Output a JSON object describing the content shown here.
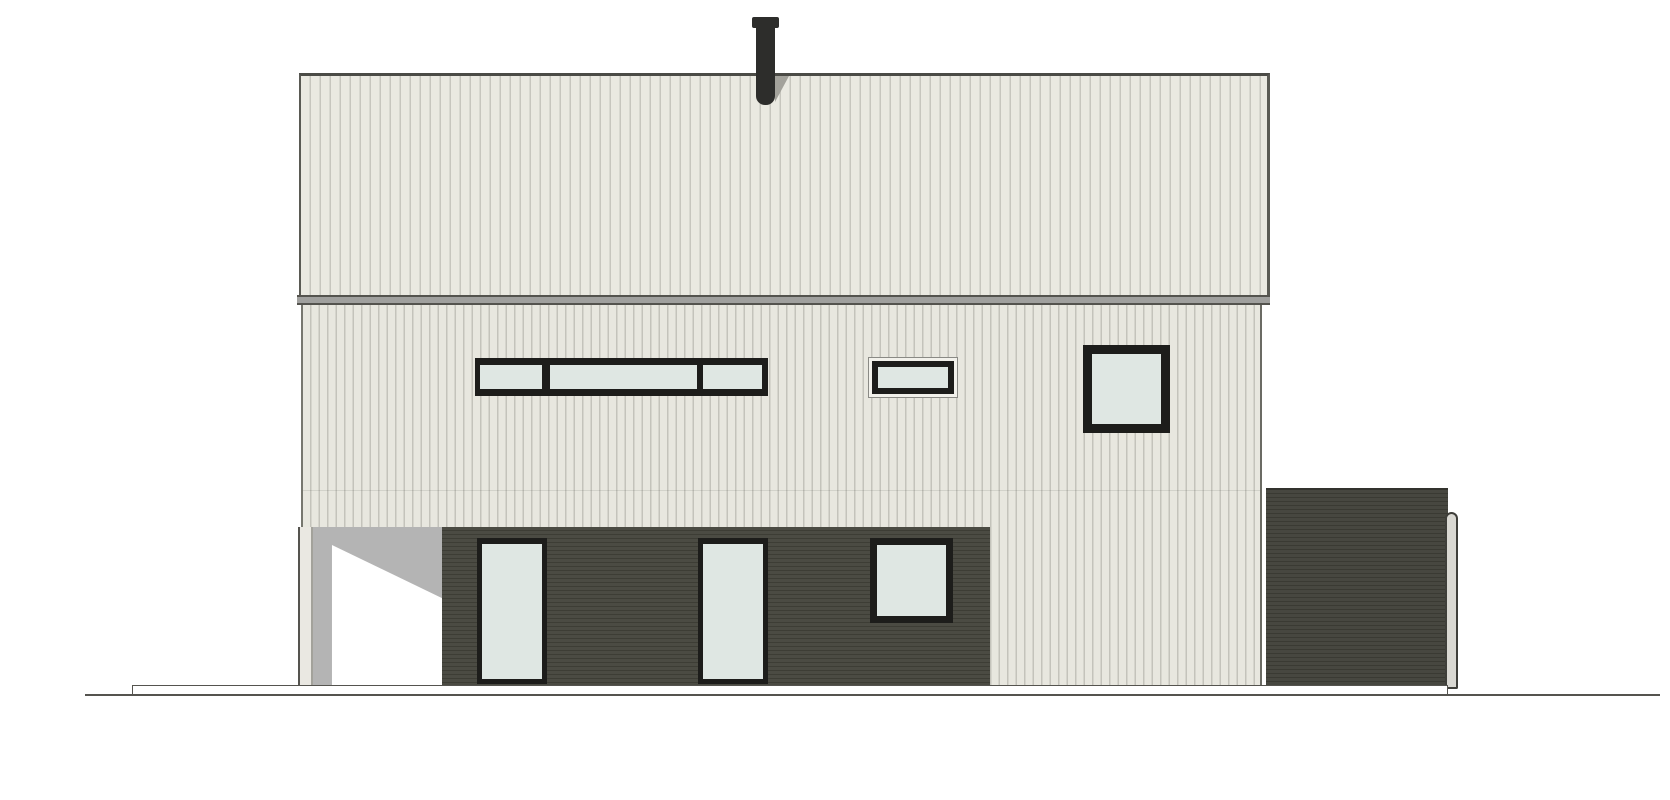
{
  "drawing": {
    "type": "architectural-elevation",
    "subject": "single-family house facade elevation",
    "text_labels": [],
    "elements": {
      "roof_panel": "upper facade plane with vertical standing-seam cladding",
      "gutter_band": "horizontal gutter band between roof plane and wall",
      "wall_panel": "main wall with light vertical siding",
      "chimney": "dark flue pipe with cap above the roof line",
      "ribbon_window": "horizontal three-pane strip window, upper floor left",
      "transom_window": "small trimmed rectangular window, upper floor center",
      "square_window": "square window, upper floor right",
      "porch_recess": "recessed open porch with cast shadow and corner pillar",
      "cladding_band": "dark horizontal-boarded cladding band on ground floor",
      "glass_door_left": "full-height glazed door, ground floor left",
      "glass_door_right": "full-height glazed door, ground floor center",
      "lower_window": "square window in dark cladding band",
      "annex_block": "dark flat-roofed annex volume at right",
      "annex_downpipe": "rounded gutter downpipe at annex right edge",
      "base_platform": "thin base slab line under the building",
      "ground_line": "ground reference line"
    }
  },
  "colors": {
    "background": "#ffffff",
    "outline": "#4b4b46",
    "roof_fill": "#eae9e1",
    "roof_stripe": "#c7c6be",
    "siding_fill": "#e8e7df",
    "siding_stripe": "#c4c3bb",
    "gutter_fill": "#a0a09e",
    "gutter_edge": "#54534e",
    "dark_cladding": "#4b4b43",
    "dark_cladding_stripe": "#3d3d35",
    "window_frame": "#1d1d1b",
    "glass": "#dfe7e3",
    "porch_shadow": "#b4b4b4",
    "porch_light": "#ffffff",
    "pillar_fill": "#eae8e2",
    "chimney": "#2d2d2b",
    "annex_fill": "#474740",
    "annex_stripe": "#3a3a33",
    "downpipe_fill": "#d9d8d2",
    "downpipe_edge": "#3f3f3a",
    "ground_line": "#55544f"
  }
}
